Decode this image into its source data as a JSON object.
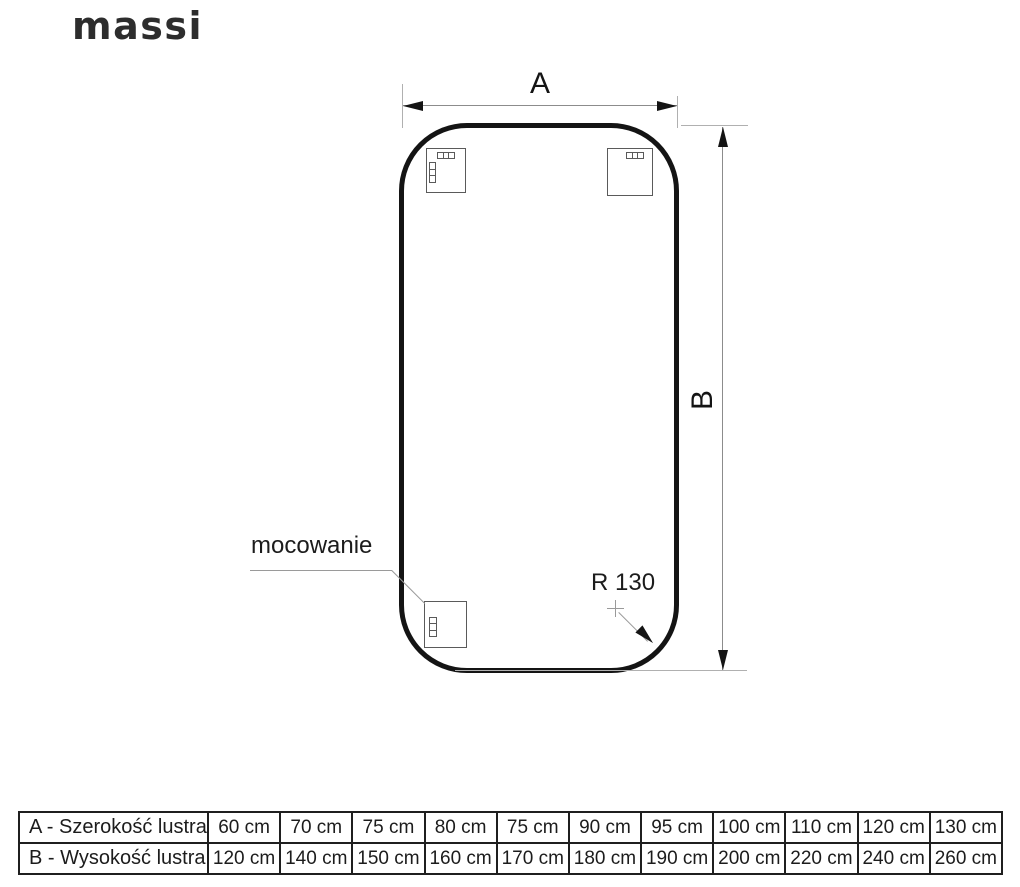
{
  "brand": {
    "logo_text": "massi"
  },
  "diagram": {
    "width_dim_label": "A",
    "height_dim_label": "B",
    "mounting_label": "mocowanie",
    "corner_radius_label": "R 130"
  },
  "colors": {
    "mirror_outline": "#141414",
    "dimension_line": "#8c8c8c",
    "extension_line": "#b0b0b0",
    "text": "#1c1c1c"
  },
  "spec_table": {
    "rows": [
      {
        "label": "A - Szerokość lustra",
        "values": [
          "60 cm",
          "70 cm",
          "75 cm",
          "80 cm",
          "75 cm",
          "90 cm",
          "95 cm",
          "100 cm",
          "110 cm",
          "120 cm",
          "130 cm"
        ]
      },
      {
        "label": "B - Wysokość lustra",
        "values": [
          "120 cm",
          "140 cm",
          "150 cm",
          "160 cm",
          "170 cm",
          "180 cm",
          "190 cm",
          "200 cm",
          "220 cm",
          "240 cm",
          "260 cm"
        ]
      }
    ]
  }
}
